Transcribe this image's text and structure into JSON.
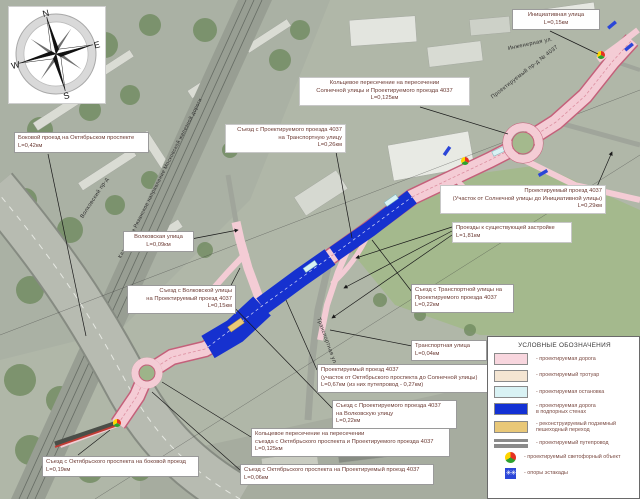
{
  "compass": {
    "n": "N",
    "e": "E",
    "s": "S",
    "w": "W"
  },
  "callouts": [
    {
      "id": "initiative-street",
      "text": "Инициативная улица\nL=0,15км"
    },
    {
      "id": "ring-top",
      "text": "Кольцевое пересечение на пересечении\nСолнечной улицы и Проектируемого проезда 4037\nL=0,125км"
    },
    {
      "id": "exit-to-transport",
      "text": "Съезд с Проектируемого проезда 4037\nна Транспортную улицу\nL=0,26км"
    },
    {
      "id": "side-drive",
      "text": "Боковой проезд на Октябрьском проспекте\nL=0,42км"
    },
    {
      "id": "pr4037-sun-init",
      "text": "Проектируемый проезд 4037\n(Участок от Солнечной улицы до Инициативной улицы)\nL=0,29км"
    },
    {
      "id": "drives-existing",
      "text": "Проезды к существующей застройке\nL=1,81км"
    },
    {
      "id": "volkov-street",
      "text": "Волковская улица\nL=0,09км"
    },
    {
      "id": "exit-volkov",
      "text": "Съезд с Волковской улицы\nна Проектируемый проезд 4037\nL=0,15км"
    },
    {
      "id": "exit-from-transport",
      "text": "Съезд с Транспортной улицы на\nПроектируемого проезда 4037\nL=0,22км"
    },
    {
      "id": "transport-street",
      "text": "Транспортная улица\nL=0,04км"
    },
    {
      "id": "pr4037-okt-sun",
      "text": "Проектируемый проезд 4037\n(участок от Октябрьского проспекта до Солнечной улицы)\nL=0,67км (из них путепровод - 0,27км)"
    },
    {
      "id": "exit-to-volkov",
      "text": "Съезд с Проектируемого проезда 4037\nна Волковскую улицу\nL=0,22км"
    },
    {
      "id": "ring-bottom",
      "text": "Кольцевое пересечение на пересечении\nсъезда с Октябрьского проспекта и Проектируемого проезда 4037\nL=0,125км"
    },
    {
      "id": "exit-okt-pr",
      "text": "Съезд с Октябрьского проспекта на Проектируемый проезд 4037\nL=0,06км"
    },
    {
      "id": "exit-okt-side",
      "text": "Съезд с Октябрьского проспекта на боковой проезд\nL=0,19км"
    }
  ],
  "street_labels": [
    {
      "text": "Казанское и Рязанское направление Московской железной дороги"
    },
    {
      "text": "Проектируемый пр-д № 4037"
    },
    {
      "text": "Инженерная ул."
    },
    {
      "text": "Волковский пр-д"
    },
    {
      "text": "Транспортная ул."
    }
  ],
  "legend": {
    "title": "УСЛОВНЫЕ ОБОЗНАЧЕНИЯ",
    "support_glyph": "✳✳",
    "items": [
      {
        "label": "- проектируемая дорога",
        "color": "#f8d6de"
      },
      {
        "label": "- проектируемый тротуар",
        "color": "#f4e5d2"
      },
      {
        "label": "- проектируемая остановка",
        "color": "#d9f2f4"
      },
      {
        "label": "- проектируемая дорога\nв подпорных стенах",
        "color": "#1331d4"
      },
      {
        "label": "- реконструируемый подземный\nпешеходный переход",
        "color": "#e9c878"
      },
      {
        "label": "- проектируемый путепровод",
        "color": "#8b8b8b"
      },
      {
        "label": "- проектируемый светофорный объект",
        "color": ""
      },
      {
        "label": "- опоры эстакады",
        "color": "#2b46d8"
      }
    ]
  },
  "colors": {
    "project_road": "#f4ccd5",
    "project_road_edge": "#c4607a",
    "retaining_wall_road": "#1631cf",
    "callout_text": "#6b3a33"
  }
}
